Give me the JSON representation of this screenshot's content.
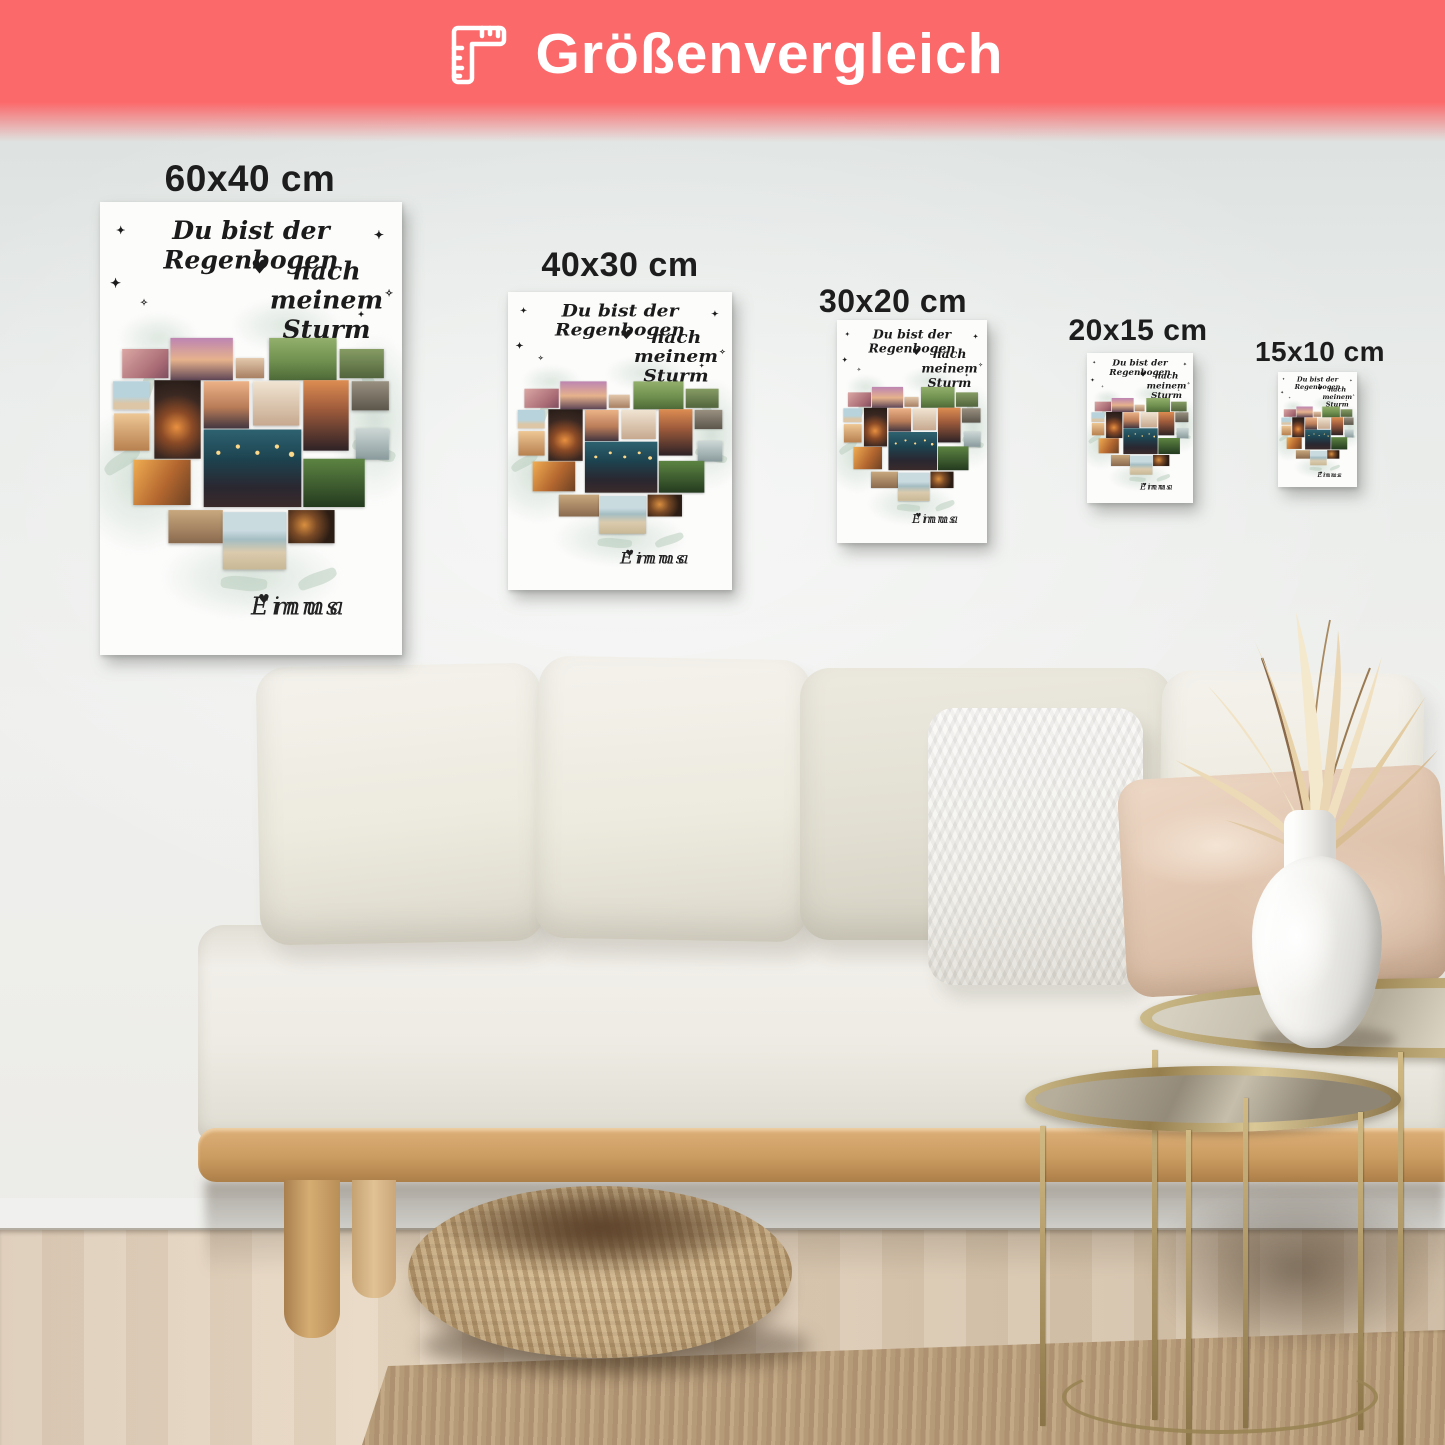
{
  "banner": {
    "title": "Größenvergleich",
    "icon": "corner-ruler-icon",
    "bg_color": "#fc696b",
    "text_color": "#ffffff"
  },
  "size_labels": [
    {
      "label": "60x40 cm"
    },
    {
      "label": "40x30 cm"
    },
    {
      "label": "30x20 cm"
    },
    {
      "label": "20x15 cm"
    },
    {
      "label": "15x10 cm"
    }
  ],
  "poster": {
    "title_line1": "Du bist der Regenbogen",
    "title_line2": "nach meinem Sturm",
    "title_heart": "♥",
    "sparkle": "✦",
    "sparkle_alt": "✧",
    "name_left": "Linus",
    "names_heart": "♥",
    "name_right": "Emma"
  }
}
